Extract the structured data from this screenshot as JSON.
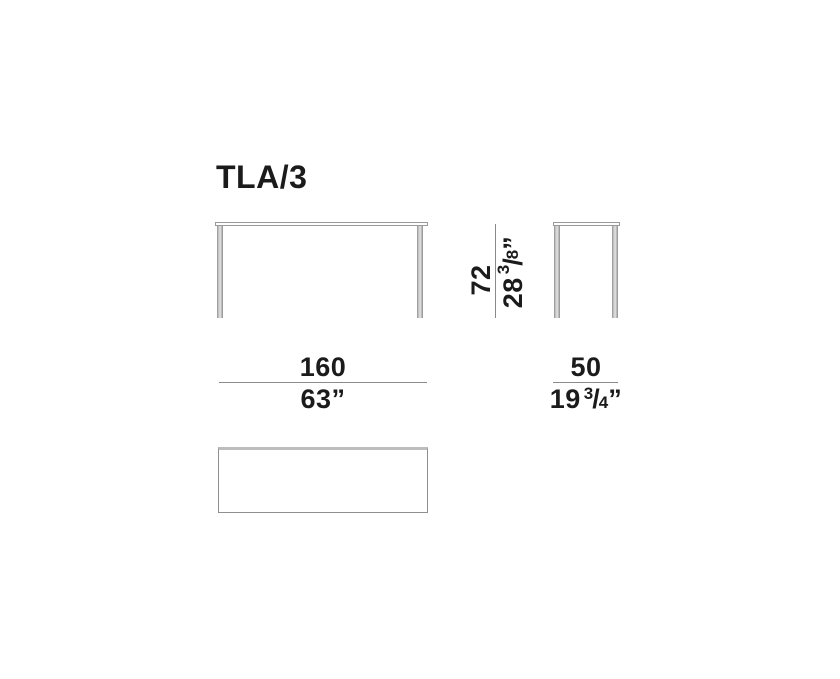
{
  "title": "TLA/3",
  "colors": {
    "background": "#ffffff",
    "text": "#1b1b1b",
    "dimension_line": "#8a8a8a",
    "drawing_outline": "#9a9a9a",
    "leg_fill": "#c9c9c9",
    "plan_top_edge": "#bdbdbd"
  },
  "dimensions": {
    "height": {
      "cm": "72",
      "inches": {
        "main": "28",
        "numerator": "3",
        "slash": "/",
        "denominator": "8",
        "quote": "”"
      }
    },
    "width": {
      "cm": "160",
      "inches": "63”"
    },
    "depth": {
      "cm": "50",
      "inches": {
        "main": "19",
        "numerator": "3",
        "slash": "/",
        "denominator": "4",
        "quote": "”"
      }
    }
  }
}
